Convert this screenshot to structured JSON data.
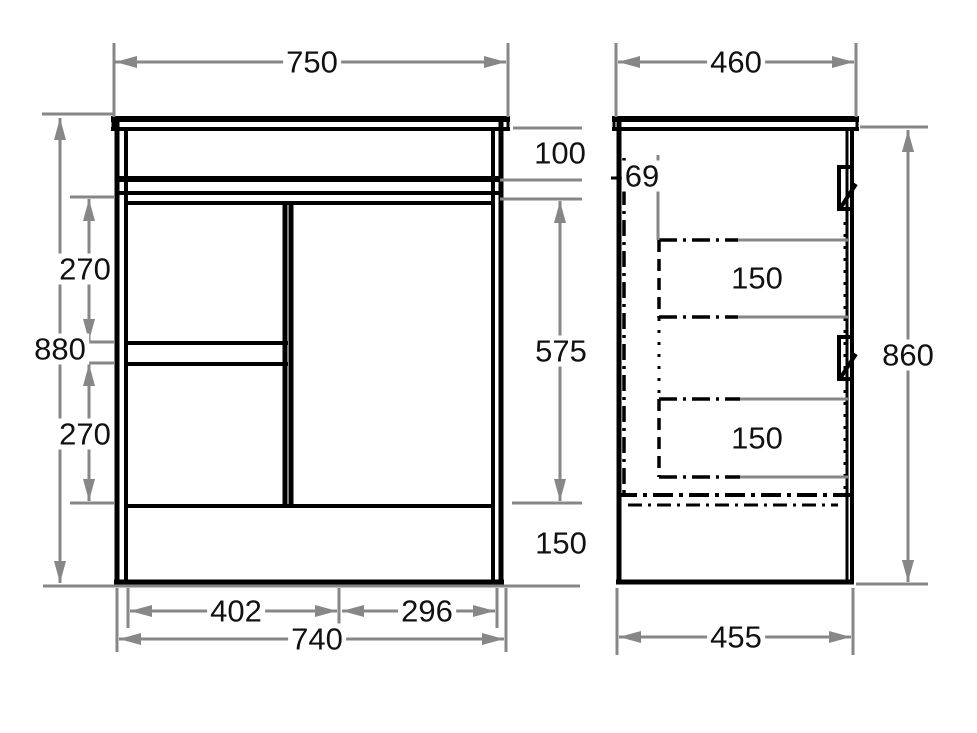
{
  "front_view": {
    "dimensions": {
      "top_width": "750",
      "overall_height": "880",
      "top_section_height": "100",
      "upper_drawer_height": "270",
      "lower_drawer_height": "270",
      "door_height": "575",
      "kickboard_height": "150",
      "bottom_left_width": "402",
      "bottom_right_width": "296",
      "bottom_width": "740"
    }
  },
  "side_view": {
    "dimensions": {
      "top_depth": "460",
      "top_inset": "69",
      "upper_drawer_depth": "150",
      "lower_drawer_depth": "150",
      "body_height": "860",
      "bottom_depth": "455"
    }
  },
  "colors": {
    "background": "#ffffff",
    "outline": "#000000",
    "dimension_line": "#878787",
    "label_text": "#111111"
  }
}
